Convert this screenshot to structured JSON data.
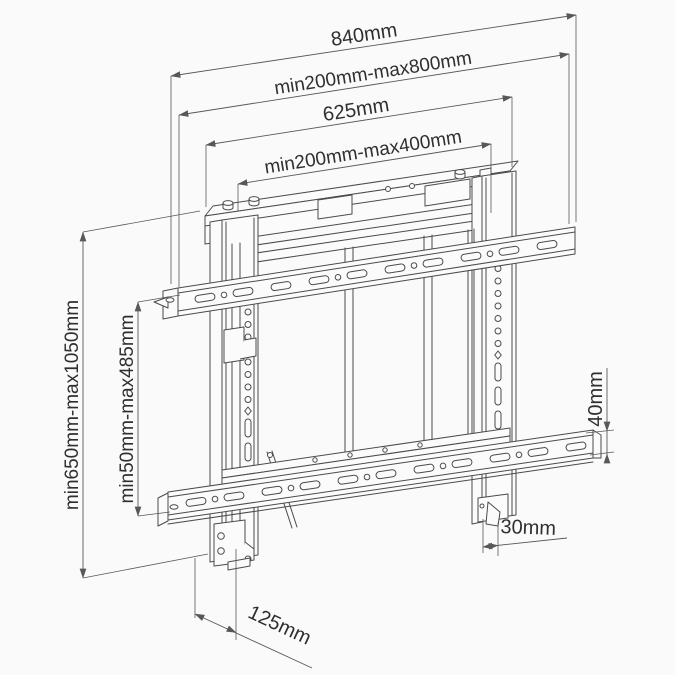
{
  "colors": {
    "background": "#fafafa",
    "drawing_line": "#4b4b4b",
    "dimension_line": "#585858",
    "text": "#2f2f2f"
  },
  "dims": {
    "top": [
      {
        "id": "overall-width",
        "label": "840mm"
      },
      {
        "id": "adjustable-width-range",
        "label": "min200mm-max800mm"
      },
      {
        "id": "inner-width",
        "label": "625mm"
      },
      {
        "id": "vesa-width-range",
        "label": "min200mm-max400mm"
      }
    ],
    "left": [
      {
        "id": "overall-height-range",
        "label": "min650mm-max1050mm"
      },
      {
        "id": "vesa-height-range",
        "label": "min50mm-max485mm"
      }
    ],
    "right": [
      {
        "id": "rail-height",
        "label": "40mm"
      },
      {
        "id": "bottom-offset",
        "label": "30mm"
      }
    ],
    "bottom": [
      {
        "id": "depth",
        "label": "125mm"
      }
    ]
  }
}
